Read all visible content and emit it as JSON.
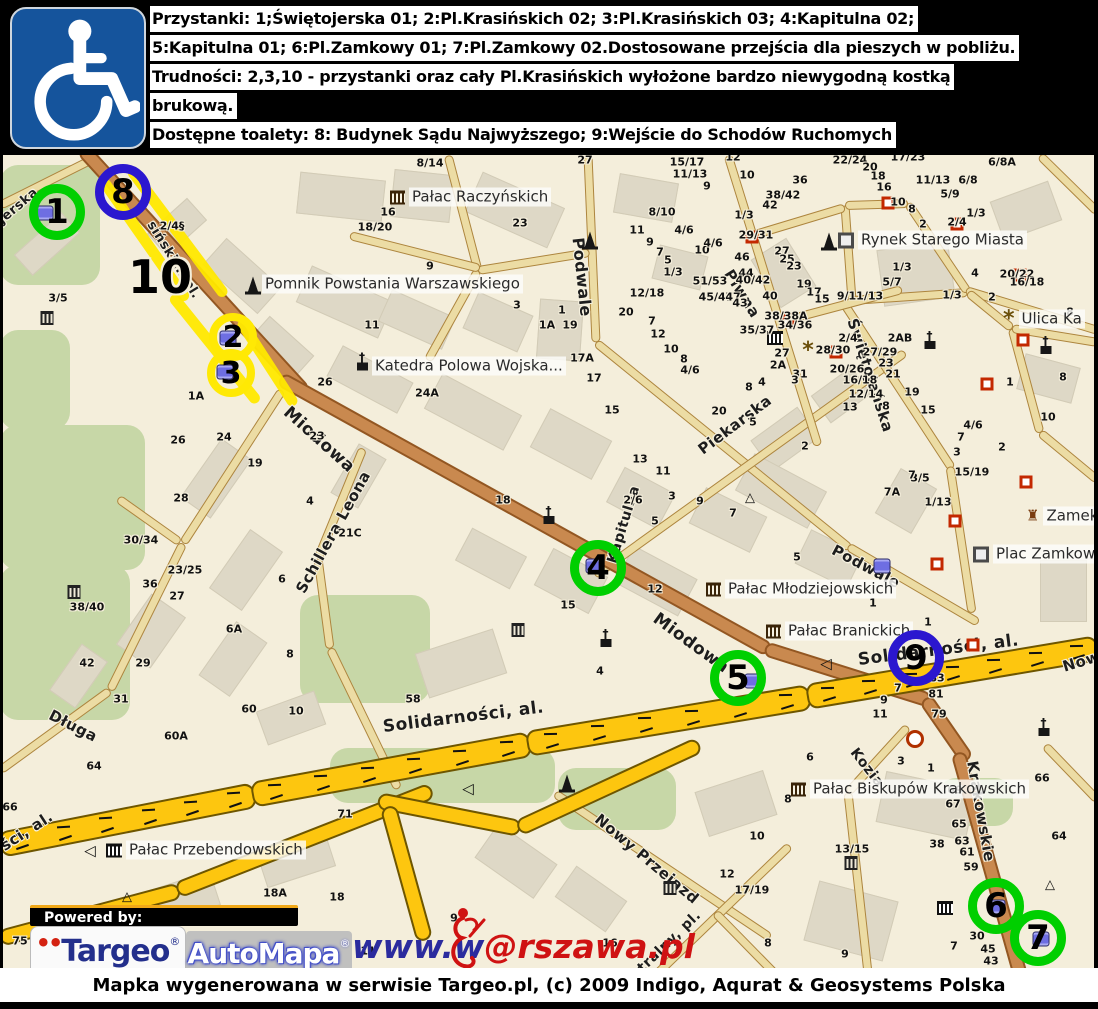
{
  "header": {
    "lines": [
      "Przystanki: 1;Świętojerska 01; 2:Pl.Krasińskich 02; 3:Pl.Krasińskich 03; 4:Kapitulna 02;",
      "5:Kapitulna 01; 6:Pl.Zamkowy 01; 7:Pl.Zamkowy 02.Dostosowane przejścia dla pieszych w pobliżu.",
      "Trudności: 2,3,10 - przystanki oraz cały Pl.Krasińskich wyłożone bardzo niewygodną kostką",
      "brukową.",
      "Dostępne toalety: 8: Budynek Sądu Najwyższego; 9:Wejście do Schodów Ruchomych"
    ]
  },
  "map": {
    "street_labels": [
      {
        "t": "jerska",
        "x": 0,
        "y": 214,
        "r": -40,
        "s": 13
      },
      {
        "t": "sińskich pl.",
        "x": 150,
        "y": 215,
        "r": 58,
        "s": 13
      },
      {
        "t": "Podwale",
        "x": 578,
        "y": 228,
        "r": 84,
        "s": 16
      },
      {
        "t": "Miodowa",
        "x": 286,
        "y": 400,
        "r": 42,
        "s": 17
      },
      {
        "t": "Miodowa",
        "x": 655,
        "y": 607,
        "r": 36,
        "s": 17
      },
      {
        "t": "Piwna",
        "x": 728,
        "y": 262,
        "r": 58,
        "s": 15
      },
      {
        "t": "Świętojańska",
        "x": 852,
        "y": 310,
        "r": 72,
        "s": 15
      },
      {
        "t": "Schillera Leona",
        "x": 300,
        "y": 583,
        "r": -61,
        "s": 15
      },
      {
        "t": "Długa",
        "x": 50,
        "y": 705,
        "r": 27,
        "s": 15
      },
      {
        "t": "Piekarska",
        "x": 700,
        "y": 442,
        "r": -37,
        "s": 15
      },
      {
        "t": "Kapitulna",
        "x": 612,
        "y": 555,
        "r": -73,
        "s": 14
      },
      {
        "t": "Podwale",
        "x": 833,
        "y": 540,
        "r": 28,
        "s": 15
      },
      {
        "t": "Solidarności, al.",
        "x": 383,
        "y": 717,
        "r": -7,
        "s": 17
      },
      {
        "t": "Solidarności, al.",
        "x": 858,
        "y": 650,
        "r": -7,
        "s": 17
      },
      {
        "t": "Nowy",
        "x": 1063,
        "y": 658,
        "r": -17,
        "s": 15
      },
      {
        "t": "Kozia",
        "x": 853,
        "y": 742,
        "r": 52,
        "s": 14
      },
      {
        "t": "Krakowskie",
        "x": 972,
        "y": 752,
        "r": 80,
        "s": 15
      },
      {
        "t": "Nowy Przejazd",
        "x": 597,
        "y": 808,
        "r": 40,
        "s": 15
      },
      {
        "t": "tralny, pl.",
        "x": 640,
        "y": 962,
        "r": -44,
        "s": 14
      },
      {
        "t": "ści, al.",
        "x": 2,
        "y": 838,
        "r": -33,
        "s": 15
      }
    ],
    "pois": [
      {
        "t": "Pałac Raczyńskich",
        "icon": "palace",
        "x": 390,
        "y": 197
      },
      {
        "t": "Pomnik Powstania Warszawskiego",
        "icon": "monument",
        "x": 248,
        "y": 284
      },
      {
        "t": "Rynek Starego Miasta",
        "icon": "monument-square",
        "x": 824,
        "y": 240
      },
      {
        "t": "Ulica Ka",
        "icon": "star",
        "x": 1003,
        "y": 319
      },
      {
        "t": "Katedra Polowa Wojska...",
        "icon": "church",
        "x": 357,
        "y": 366
      },
      {
        "t": "Zamek",
        "icon": "castle",
        "x": 1026,
        "y": 516
      },
      {
        "t": "Plac Zamkow",
        "icon": "graysquare",
        "x": 973,
        "y": 554
      },
      {
        "t": "Pałac Młodziejowskich",
        "icon": "palace",
        "x": 706,
        "y": 589
      },
      {
        "t": "Pałac Branickich",
        "icon": "palace",
        "x": 766,
        "y": 631
      },
      {
        "t": "Pałac Biskupów Krakowskich",
        "icon": "palace",
        "x": 791,
        "y": 789
      },
      {
        "t": "Pałac Przebendowskich",
        "icon": "bank",
        "x": 106,
        "y": 850
      }
    ],
    "markers": [
      {
        "n": "1",
        "color": "green",
        "x": 57,
        "y": 212
      },
      {
        "n": "8",
        "color": "blue",
        "x": 123,
        "y": 192
      },
      {
        "n": "2",
        "color": "yellow",
        "x": 233,
        "y": 337
      },
      {
        "n": "3",
        "color": "yellow",
        "x": 231,
        "y": 373
      },
      {
        "n": "4",
        "color": "green",
        "x": 598,
        "y": 568
      },
      {
        "n": "5",
        "color": "green",
        "x": 738,
        "y": 678
      },
      {
        "n": "9",
        "color": "blue",
        "x": 916,
        "y": 658
      },
      {
        "n": "6",
        "color": "green",
        "x": 996,
        "y": 906
      },
      {
        "n": "7",
        "color": "green",
        "x": 1038,
        "y": 938
      }
    ],
    "route_number": {
      "t": "10",
      "x": 160,
      "y": 277
    },
    "icons": [
      {
        "type": "bus",
        "x": 45,
        "y": 213
      },
      {
        "type": "bus",
        "x": 228,
        "y": 338
      },
      {
        "type": "bus",
        "x": 225,
        "y": 372
      },
      {
        "type": "bus",
        "x": 594,
        "y": 566
      },
      {
        "type": "bus",
        "x": 753,
        "y": 681
      },
      {
        "type": "bus",
        "x": 882,
        "y": 566
      },
      {
        "type": "bus",
        "x": 997,
        "y": 907
      },
      {
        "type": "bus",
        "x": 1041,
        "y": 939
      },
      {
        "type": "red",
        "x": 888,
        "y": 203
      },
      {
        "type": "red",
        "x": 957,
        "y": 224
      },
      {
        "type": "red",
        "x": 752,
        "y": 237
      },
      {
        "type": "red",
        "x": 788,
        "y": 320
      },
      {
        "type": "red",
        "x": 836,
        "y": 352
      },
      {
        "type": "red",
        "x": 1020,
        "y": 275
      },
      {
        "type": "red",
        "x": 1023,
        "y": 340
      },
      {
        "type": "red",
        "x": 987,
        "y": 384
      },
      {
        "type": "red",
        "x": 955,
        "y": 521
      },
      {
        "type": "red",
        "x": 937,
        "y": 564
      },
      {
        "type": "red",
        "x": 973,
        "y": 645
      },
      {
        "type": "red",
        "x": 1026,
        "y": 482
      },
      {
        "type": "church",
        "x": 930,
        "y": 345
      },
      {
        "type": "church",
        "x": 1046,
        "y": 350
      },
      {
        "type": "church",
        "x": 549,
        "y": 520
      },
      {
        "type": "church",
        "x": 606,
        "y": 643
      },
      {
        "type": "church",
        "x": 1044,
        "y": 732
      },
      {
        "type": "monument",
        "x": 590,
        "y": 239
      },
      {
        "type": "monument",
        "x": 567,
        "y": 782
      },
      {
        "type": "bank",
        "x": 945,
        "y": 908
      },
      {
        "type": "bank",
        "x": 775,
        "y": 338
      },
      {
        "type": "building",
        "x": 47,
        "y": 318
      },
      {
        "type": "building",
        "x": 74,
        "y": 592
      },
      {
        "type": "building",
        "x": 518,
        "y": 630
      },
      {
        "type": "building",
        "x": 670,
        "y": 888
      },
      {
        "type": "building",
        "x": 851,
        "y": 863
      },
      {
        "type": "star",
        "x": 808,
        "y": 351
      },
      {
        "type": "arrow-left",
        "x": 90,
        "y": 851
      },
      {
        "type": "arrow-left",
        "x": 468,
        "y": 789
      },
      {
        "type": "arrow-left",
        "x": 826,
        "y": 664
      },
      {
        "type": "triangle",
        "x": 750,
        "y": 498
      },
      {
        "type": "triangle",
        "x": 1050,
        "y": 885
      },
      {
        "type": "triangle",
        "x": 127,
        "y": 897
      },
      {
        "type": "junction",
        "x": 915,
        "y": 739
      }
    ],
    "house_numbers": [
      [
        "2/4§",
        172,
        226
      ],
      [
        "3/5",
        58,
        298
      ],
      [
        "1A",
        196,
        396
      ],
      [
        "26",
        325,
        382
      ],
      [
        "8/14",
        430,
        163
      ],
      [
        "16",
        388,
        212
      ],
      [
        "18/20",
        375,
        227
      ],
      [
        "27",
        585,
        160
      ],
      [
        "23",
        520,
        223
      ],
      [
        "9",
        430,
        266
      ],
      [
        "3",
        517,
        305
      ],
      [
        "1",
        562,
        310
      ],
      [
        "1A",
        547,
        325
      ],
      [
        "19",
        570,
        325
      ],
      [
        "17A",
        582,
        358
      ],
      [
        "17",
        594,
        378
      ],
      [
        "15",
        612,
        410
      ],
      [
        "11",
        372,
        325
      ],
      [
        "24A",
        427,
        393
      ],
      [
        "8/10",
        662,
        212
      ],
      [
        "11",
        637,
        230
      ],
      [
        "9",
        650,
        242
      ],
      [
        "7",
        660,
        252
      ],
      [
        "5",
        668,
        260
      ],
      [
        "1/3",
        673,
        272
      ],
      [
        "4/6",
        684,
        230
      ],
      [
        "10",
        702,
        250
      ],
      [
        "4/6",
        713,
        243
      ],
      [
        "12/18",
        647,
        293
      ],
      [
        "20",
        626,
        312
      ],
      [
        "7",
        652,
        321
      ],
      [
        "12",
        658,
        334
      ],
      [
        "10",
        671,
        349
      ],
      [
        "8",
        684,
        359
      ],
      [
        "4/6",
        690,
        370
      ],
      [
        "15/17",
        687,
        162
      ],
      [
        "11/13",
        690,
        174
      ],
      [
        "9",
        707,
        186
      ],
      [
        "51/53",
        710,
        281
      ],
      [
        "45/47",
        716,
        297
      ],
      [
        "12",
        733,
        157
      ],
      [
        "10",
        747,
        175
      ],
      [
        "36",
        800,
        180
      ],
      [
        "38/42",
        783,
        195
      ],
      [
        "42",
        770,
        205
      ],
      [
        "1/3",
        744,
        215
      ],
      [
        "29/31",
        756,
        235
      ],
      [
        "46",
        742,
        257
      ],
      [
        "27",
        782,
        251
      ],
      [
        "25",
        787,
        259
      ],
      [
        "23",
        794,
        266
      ],
      [
        "44",
        746,
        273
      ],
      [
        "40/42",
        753,
        280
      ],
      [
        "40",
        770,
        296
      ],
      [
        "47",
        733,
        297
      ],
      [
        "43",
        740,
        303
      ],
      [
        "19",
        804,
        284
      ],
      [
        "17",
        814,
        292
      ],
      [
        "15",
        822,
        299
      ],
      [
        "9/11/13",
        860,
        296
      ],
      [
        "1/3",
        902,
        267
      ],
      [
        "5/7",
        892,
        282
      ],
      [
        "22/24",
        850,
        160
      ],
      [
        "20",
        870,
        167
      ],
      [
        "18",
        878,
        176
      ],
      [
        "16",
        884,
        187
      ],
      [
        "17/23",
        908,
        157
      ],
      [
        "11/13",
        933,
        180
      ],
      [
        "6/8",
        968,
        180
      ],
      [
        "5/9",
        950,
        194
      ],
      [
        "6/8A",
        1002,
        162
      ],
      [
        "10",
        898,
        202
      ],
      [
        "8",
        912,
        209
      ],
      [
        "2",
        923,
        224
      ],
      [
        "2/4",
        957,
        222
      ],
      [
        "1/3",
        976,
        213
      ],
      [
        "38/38A",
        786,
        316
      ],
      [
        "34/36",
        795,
        325
      ],
      [
        "35/37",
        757,
        330
      ],
      [
        "28/30",
        833,
        350
      ],
      [
        "2/4",
        848,
        338
      ],
      [
        "27",
        782,
        353
      ],
      [
        "2A",
        778,
        365
      ],
      [
        "31",
        800,
        374
      ],
      [
        "20/26",
        847,
        369
      ],
      [
        "16/18",
        860,
        380
      ],
      [
        "12/14",
        866,
        394
      ],
      [
        "13",
        850,
        407
      ],
      [
        "8",
        886,
        406
      ],
      [
        "2AB",
        900,
        338
      ],
      [
        "27/29",
        880,
        352
      ],
      [
        "23",
        886,
        363
      ],
      [
        "21",
        893,
        374
      ],
      [
        "19",
        912,
        392
      ],
      [
        "15",
        928,
        410
      ],
      [
        "4",
        975,
        273
      ],
      [
        "20/22",
        1017,
        274
      ],
      [
        "16/18",
        1027,
        282
      ],
      [
        "1/3",
        952,
        295
      ],
      [
        "2",
        992,
        297
      ],
      [
        "8",
        1070,
        312
      ],
      [
        "1",
        1010,
        382
      ],
      [
        "10",
        1048,
        417
      ],
      [
        "8",
        1063,
        377
      ],
      [
        "4/6",
        973,
        425
      ],
      [
        "7",
        961,
        437
      ],
      [
        "3",
        957,
        452
      ],
      [
        "2",
        1002,
        447
      ],
      [
        "15/19",
        972,
        472
      ],
      [
        "3/5",
        920,
        478
      ],
      [
        "7A",
        892,
        492
      ],
      [
        "7",
        912,
        475
      ],
      [
        "1/13",
        938,
        502
      ],
      [
        "18",
        503,
        500
      ],
      [
        "15",
        568,
        605
      ],
      [
        "12",
        655,
        589
      ],
      [
        "5",
        797,
        557
      ],
      [
        "1",
        873,
        603
      ],
      [
        "1",
        928,
        622
      ],
      [
        "2/6",
        633,
        500
      ],
      [
        "3",
        672,
        496
      ],
      [
        "5",
        655,
        521
      ],
      [
        "9",
        700,
        501
      ],
      [
        "7",
        733,
        513
      ],
      [
        "13",
        640,
        459
      ],
      [
        "11",
        663,
        471
      ],
      [
        "20",
        719,
        411
      ],
      [
        "5",
        753,
        422
      ],
      [
        "8",
        749,
        387
      ],
      [
        "4",
        762,
        382
      ],
      [
        "3",
        795,
        380
      ],
      [
        "2",
        805,
        446
      ],
      [
        "4",
        600,
        671
      ],
      [
        "26",
        178,
        440
      ],
      [
        "24",
        224,
        437
      ],
      [
        "19",
        255,
        463
      ],
      [
        "23",
        317,
        436
      ],
      [
        "28",
        181,
        498
      ],
      [
        "4",
        310,
        501
      ],
      [
        "30/34",
        141,
        540
      ],
      [
        "21C",
        350,
        533
      ],
      [
        "23/25",
        185,
        570
      ],
      [
        "36",
        150,
        584
      ],
      [
        "27",
        177,
        596
      ],
      [
        "6",
        282,
        579
      ],
      [
        "38/40",
        87,
        607
      ],
      [
        "6A",
        234,
        629
      ],
      [
        "8",
        290,
        654
      ],
      [
        "42",
        87,
        663
      ],
      [
        "29",
        143,
        663
      ],
      [
        "31",
        121,
        699
      ],
      [
        "60",
        249,
        709
      ],
      [
        "10",
        296,
        711
      ],
      [
        "60A",
        176,
        736
      ],
      [
        "64",
        94,
        766
      ],
      [
        "66",
        10,
        807
      ],
      [
        "71",
        345,
        814
      ],
      [
        "58",
        413,
        699
      ],
      [
        "18A",
        275,
        893
      ],
      [
        "18",
        337,
        897
      ],
      [
        "75",
        20,
        941
      ],
      [
        "9",
        454,
        918
      ],
      [
        "11",
        368,
        951
      ],
      [
        "16",
        610,
        943
      ],
      [
        "8",
        788,
        799
      ],
      [
        "10",
        757,
        836
      ],
      [
        "12",
        727,
        874
      ],
      [
        "17/19",
        752,
        890
      ],
      [
        "8",
        768,
        943
      ],
      [
        "6",
        810,
        757
      ],
      [
        "3",
        901,
        761
      ],
      [
        "1",
        931,
        768
      ],
      [
        "69",
        955,
        790
      ],
      [
        "67",
        953,
        804
      ],
      [
        "65",
        959,
        824
      ],
      [
        "63",
        962,
        841
      ],
      [
        "61",
        967,
        852
      ],
      [
        "59",
        971,
        867
      ],
      [
        "38",
        937,
        844
      ],
      [
        "13/15",
        852,
        849
      ],
      [
        "30",
        977,
        936
      ],
      [
        "45",
        988,
        949
      ],
      [
        "43",
        991,
        961
      ],
      [
        "7",
        954,
        946
      ],
      [
        "9",
        845,
        954
      ],
      [
        "66",
        1042,
        778
      ],
      [
        "64",
        1059,
        836
      ],
      [
        "9",
        884,
        700
      ],
      [
        "83",
        937,
        678
      ],
      [
        "81",
        936,
        694
      ],
      [
        "79",
        939,
        714
      ],
      [
        "11",
        880,
        714
      ],
      [
        "7",
        898,
        688
      ]
    ]
  },
  "footer": {
    "powered_by": "Powered by:",
    "targeo": "Targeo",
    "targeo_reg": "®",
    "automapa": "AutoMapa",
    "automapa_reg": "®",
    "www_left": "www.w",
    "www_right": "@rszawa.pl",
    "caption": "Mapka wygenerowana w serwisie Targeo.pl, (c) 2009 Indigo, Aqurat & Geosystems Polska"
  },
  "colors": {
    "sign_blue": "#15549c",
    "map_bg": "#f4eedb",
    "park": "#c7d7a7",
    "building": "#ded8c6",
    "road_minor": "#ecdca4",
    "road_main": "#c9894f",
    "highway": "#fdc60f",
    "route_yellow": "#ffe800",
    "marker_green": "#00cf00",
    "marker_blue": "#2b17cf",
    "marker_yellow": "#ffe904",
    "targeo_navy": "#232f8c",
    "targeo_red": "#d42212",
    "www_blue": "#2b2b9e",
    "www_red": "#cf1212"
  }
}
